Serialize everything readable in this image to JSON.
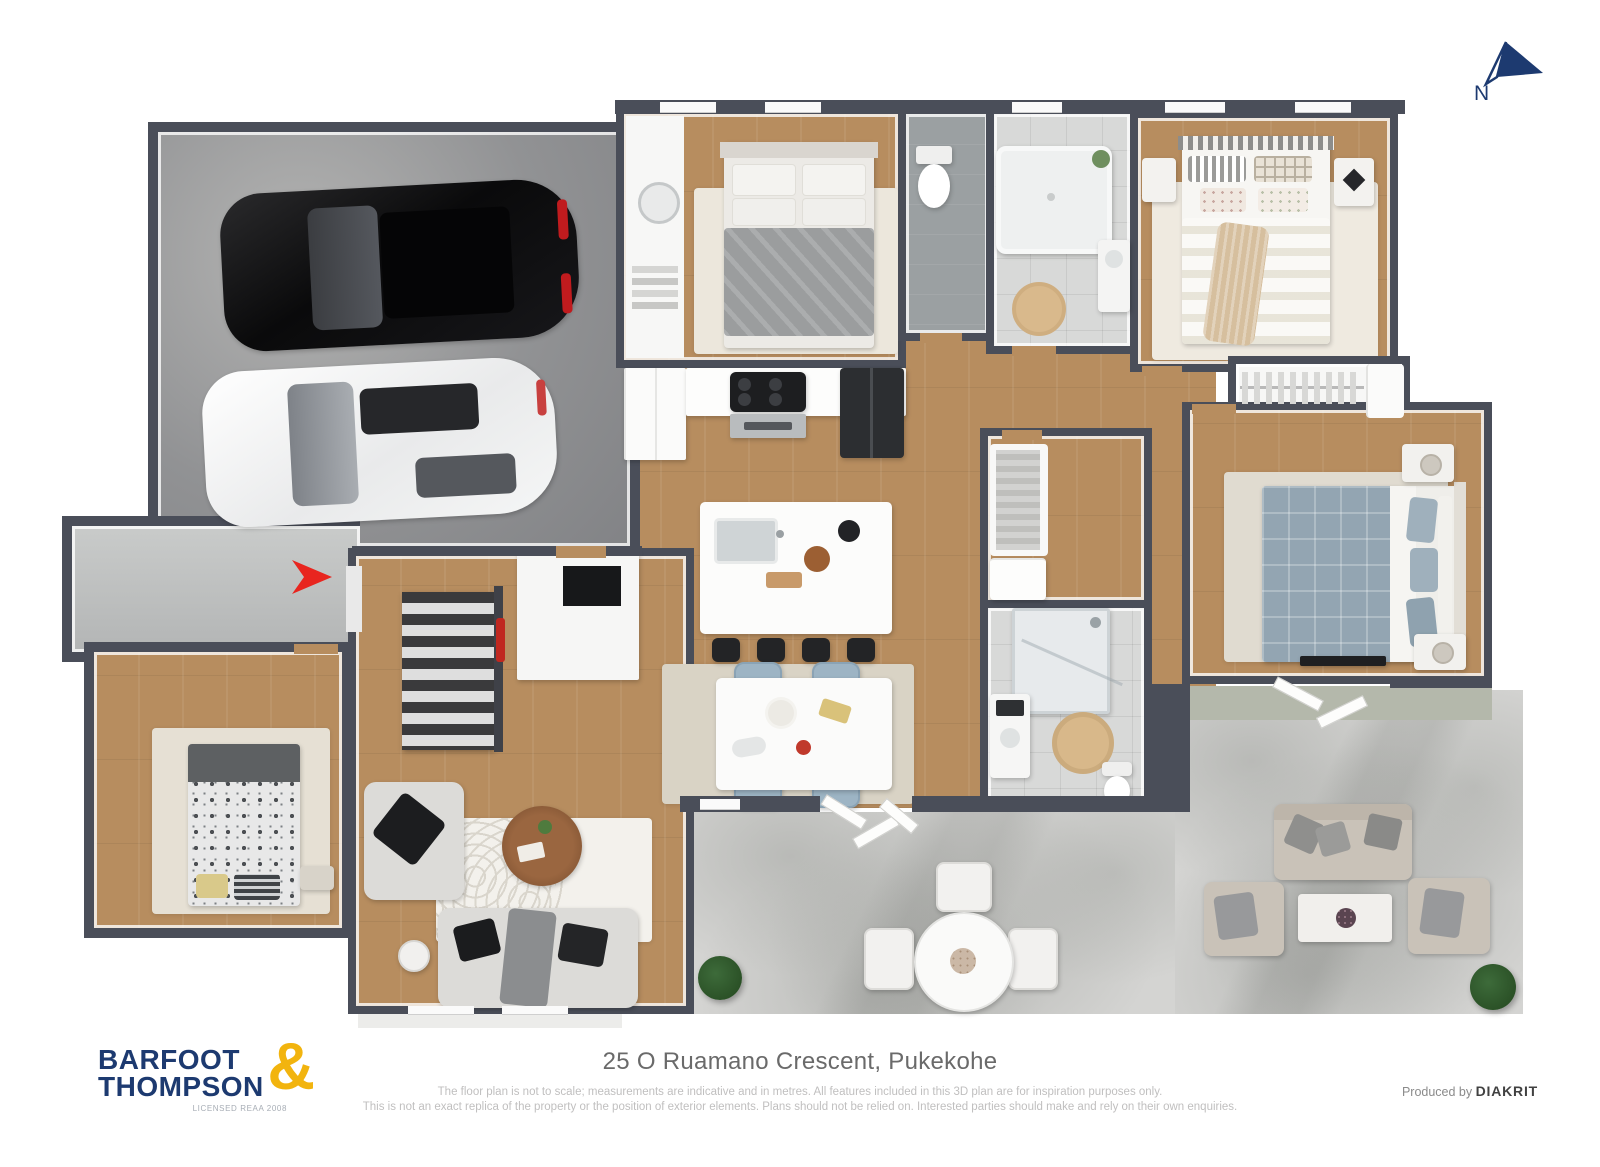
{
  "north": {
    "label": "N"
  },
  "footer": {
    "address": "25 O Ruamano Crescent, Pukekohe",
    "disclaimer_line1": "The floor plan is not to scale; measurements are indicative and in metres. All features included in this 3D plan are for inspiration purposes only.",
    "disclaimer_line2": "This is not an exact replica of the property or the position of exterior elements. Plans should not be relied on. Interested parties should make and rely on their own enquiries.",
    "produced_by": "Produced by ",
    "producer": "DIAKRIT"
  },
  "logo": {
    "line1": "BARFOOT",
    "line2": "THOMPSON",
    "ampersand": "&",
    "license": "LICENSED REAA 2008"
  },
  "colors": {
    "wall": "#4a4e59",
    "wood_floor": "#b78d5f",
    "garage_floor": "#919294",
    "patio_concrete": "#d4d4d2",
    "bathroom_tile": "#d8d9d8",
    "brand_navy": "#1d3a70",
    "brand_gold": "#f2b40e",
    "entry_arrow_red": "#e8251f",
    "master_bedding_blue": "#93a5b2",
    "dining_chair_blue": "#9db4c4"
  }
}
